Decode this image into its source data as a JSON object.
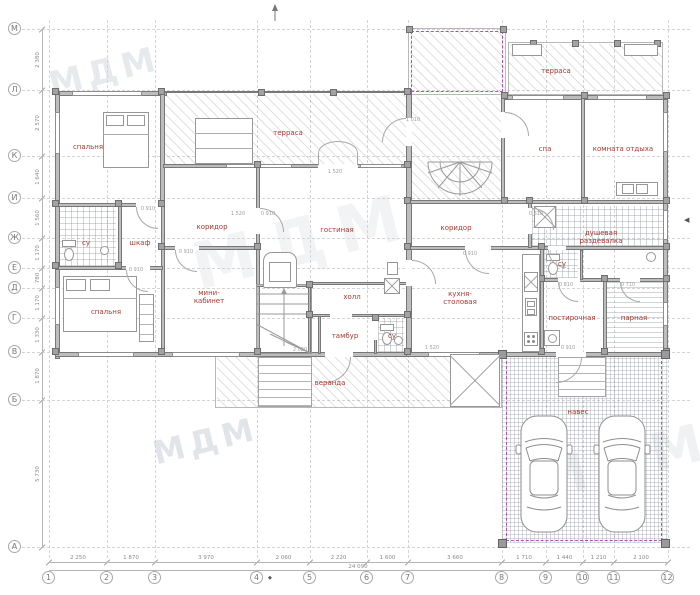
{
  "watermark": {
    "text": "МДМ"
  },
  "axes": {
    "letters": [
      [
        "М",
        29
      ],
      [
        "Л",
        90
      ],
      [
        "К",
        156
      ],
      [
        "И",
        198
      ],
      [
        "Ж",
        238
      ],
      [
        "Е",
        268
      ],
      [
        "Д",
        288
      ],
      [
        "Г",
        318
      ],
      [
        "В",
        352
      ],
      [
        "Б",
        400
      ],
      [
        "А",
        547
      ]
    ],
    "numbers": [
      [
        "1",
        49
      ],
      [
        "2",
        107
      ],
      [
        "3",
        155
      ],
      [
        "4",
        257
      ],
      [
        "5",
        310
      ],
      [
        "6",
        367
      ],
      [
        "7",
        408
      ],
      [
        "8",
        502
      ],
      [
        "9",
        546
      ],
      [
        "10",
        583
      ],
      [
        "11",
        614
      ],
      [
        "12",
        668
      ]
    ]
  },
  "dimensions": {
    "bottom": [
      "2 250",
      "1 870",
      "3 970",
      "2 060",
      "2 220",
      "1 600",
      "3 660",
      "1 710",
      "1 440",
      "1 210",
      "2 100"
    ],
    "bottom_total": "24 090",
    "left": [
      "2 380",
      "2 570",
      "1 640",
      "1 560",
      "1 170",
      "780",
      "1 170",
      "1 330",
      "1 870",
      "5 730"
    ]
  },
  "rooms": [
    {
      "name": "bedroom-top",
      "label": "спальня",
      "x": 88,
      "y": 147
    },
    {
      "name": "terrace-main",
      "label": "терраса",
      "x": 288,
      "y": 133
    },
    {
      "name": "terrace-top-right",
      "label": "терраса",
      "x": 556,
      "y": 71
    },
    {
      "name": "spa",
      "label": "спа",
      "x": 545,
      "y": 149
    },
    {
      "name": "lounge",
      "label": "комната отдыха",
      "x": 623,
      "y": 149
    },
    {
      "name": "corridor-left",
      "label": "коридор",
      "x": 212,
      "y": 227
    },
    {
      "name": "corridor-right",
      "label": "коридор",
      "x": 456,
      "y": 228
    },
    {
      "name": "shower-dressing",
      "label": "душевая",
      "label2": "раздевалка",
      "x": 601,
      "y": 237
    },
    {
      "name": "wc-left",
      "label": "су",
      "x": 86,
      "y": 243
    },
    {
      "name": "closet",
      "label": "шкаф",
      "x": 140,
      "y": 243
    },
    {
      "name": "living-room",
      "label": "гостиная",
      "x": 337,
      "y": 230
    },
    {
      "name": "mini-office",
      "label": "мини-",
      "label2": "кабинет",
      "x": 209,
      "y": 297
    },
    {
      "name": "bedroom-bottom",
      "label": "спальня",
      "x": 106,
      "y": 312
    },
    {
      "name": "hall",
      "label": "холл",
      "x": 352,
      "y": 297
    },
    {
      "name": "vestibule",
      "label": "тамбур",
      "x": 345,
      "y": 336
    },
    {
      "name": "wc-center",
      "label": "су",
      "x": 392,
      "y": 336
    },
    {
      "name": "kitchen-dining",
      "label": "кухня-",
      "label2": "столовая",
      "x": 460,
      "y": 298
    },
    {
      "name": "wc-right",
      "label": "су",
      "x": 562,
      "y": 264
    },
    {
      "name": "laundry",
      "label": "постирочная",
      "x": 572,
      "y": 318
    },
    {
      "name": "steam-room",
      "label": "парная",
      "x": 634,
      "y": 318
    },
    {
      "name": "veranda",
      "label": "веранда",
      "x": 330,
      "y": 383
    },
    {
      "name": "carport",
      "label": "навес",
      "x": 578,
      "y": 412
    }
  ],
  "annotations": [
    {
      "text": "0 910",
      "x": 148,
      "y": 209
    },
    {
      "text": "1 520",
      "x": 238,
      "y": 214
    },
    {
      "text": "1 520",
      "x": 335,
      "y": 172
    },
    {
      "text": "0 910",
      "x": 186,
      "y": 252
    },
    {
      "text": "0 910",
      "x": 268,
      "y": 214
    },
    {
      "text": "0 810",
      "x": 536,
      "y": 214
    },
    {
      "text": "0 910",
      "x": 470,
      "y": 254
    },
    {
      "text": "0 810",
      "x": 566,
      "y": 285
    },
    {
      "text": "0 710",
      "x": 628,
      "y": 285
    },
    {
      "text": "0 910",
      "x": 136,
      "y": 270
    },
    {
      "text": "1 520",
      "x": 432,
      "y": 348
    },
    {
      "text": "0 910",
      "x": 568,
      "y": 348
    },
    {
      "text": "2 020",
      "x": 300,
      "y": 350
    },
    {
      "text": "1 010",
      "x": 413,
      "y": 120
    }
  ],
  "markers": {
    "section_right": "◀",
    "benchmark": "◆"
  }
}
